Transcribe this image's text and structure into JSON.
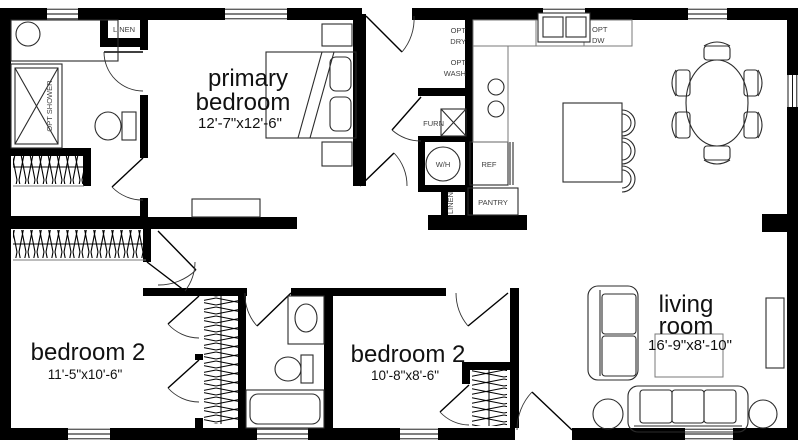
{
  "rooms": {
    "primary": {
      "line1": "primary",
      "line2": "bedroom",
      "dims": "12'-7\"x12'-6\""
    },
    "bedroom2a": {
      "line1": "bedroom 2",
      "dims": "11'-5\"x10'-6\""
    },
    "bedroom2b": {
      "line1": "bedroom 2",
      "dims": "10'-8\"x8'-6\""
    },
    "living": {
      "line1": "living",
      "line2": "room",
      "dims": "16'-9\"x8'-10\""
    }
  },
  "labels": {
    "linen_hall": "LINEN",
    "opt_shower": "OPT SHOWER",
    "opt": "OPT",
    "dry": "DRY",
    "wash": "WASH",
    "dw": "DW",
    "furn": "FURN",
    "water_heater": "W/H",
    "ref": "REF",
    "pantry": "PANTRY",
    "linen_closet": "LINEN"
  },
  "colors": {
    "wall": "#000000",
    "background": "#ffffff"
  }
}
